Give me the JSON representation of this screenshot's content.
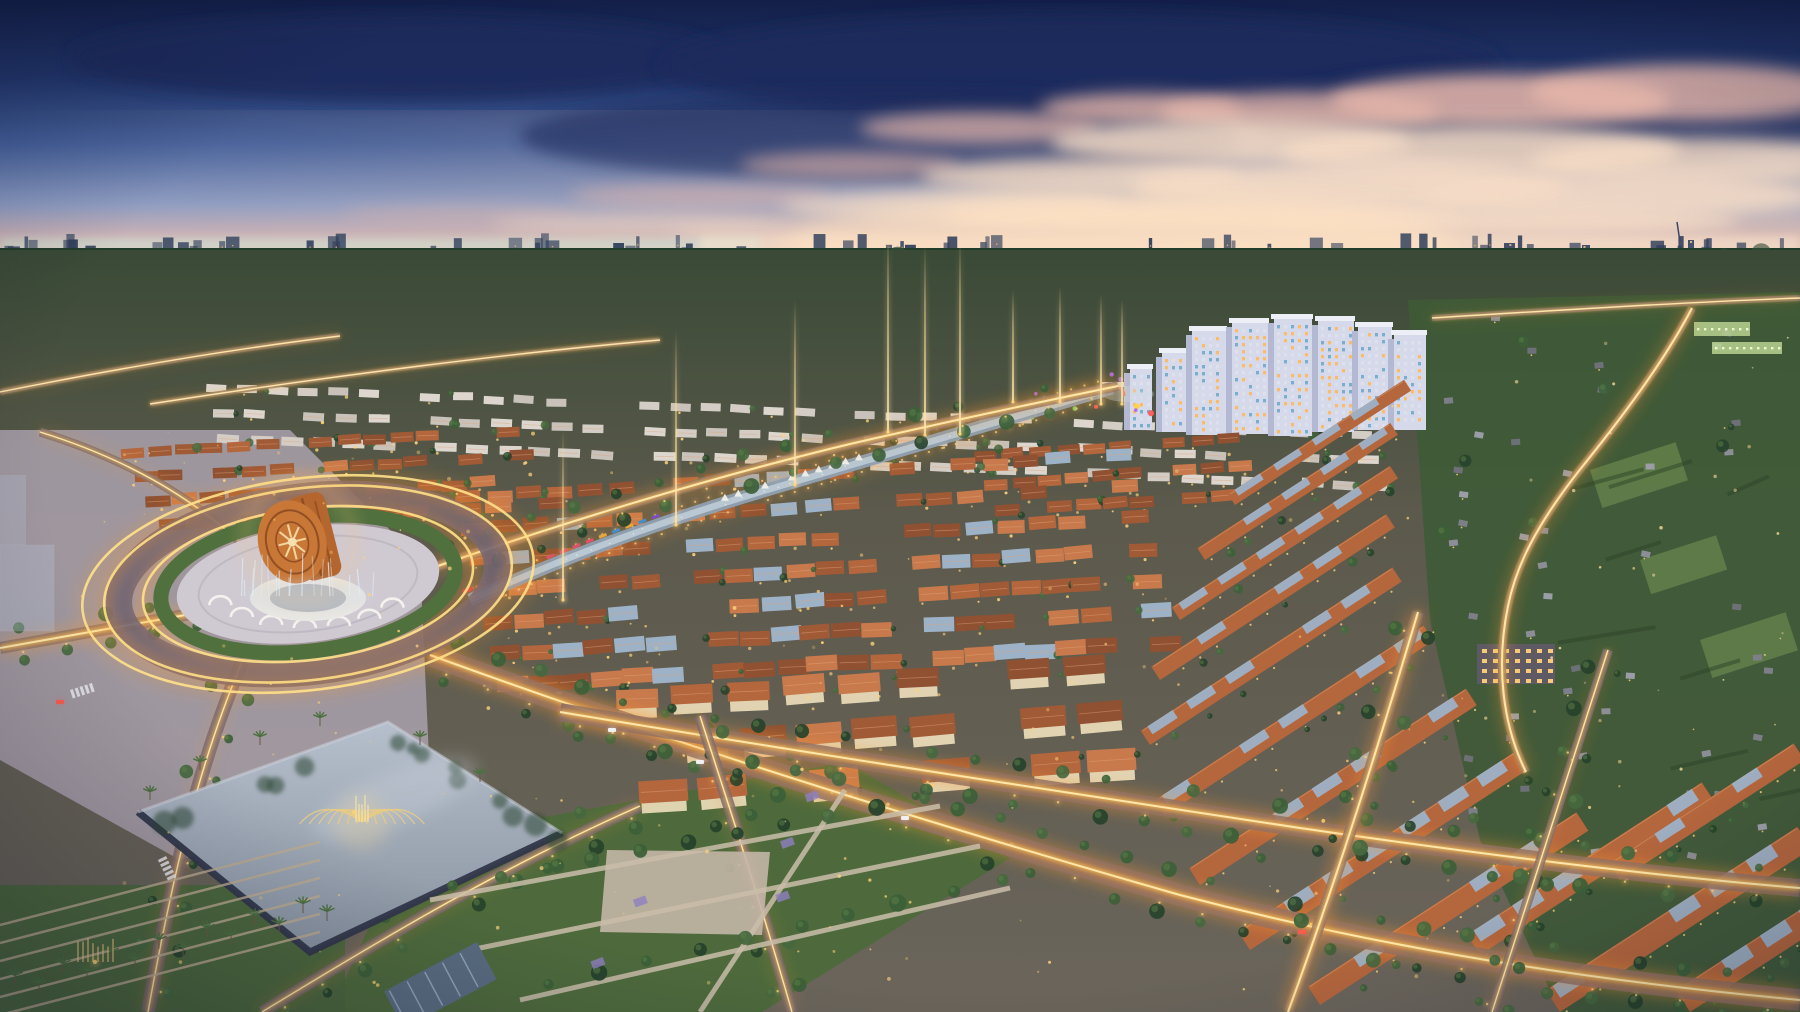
{
  "image": {
    "title": "Aerial dusk rendering of a master-planned township",
    "type": "architectural-render-photo",
    "time_of_day": "dusk",
    "width": 1800,
    "height": 1012,
    "landmarks": [
      {
        "name": "bronze-drum-monument-roundabout"
      },
      {
        "name": "musical-fountain-lake"
      },
      {
        "name": "apartment-tower-cluster"
      },
      {
        "name": "canal-promenade"
      },
      {
        "name": "villa-grid"
      },
      {
        "name": "townhouse-rows"
      },
      {
        "name": "lit-boulevards"
      },
      {
        "name": "distant-city-skyline"
      }
    ]
  },
  "palette": {
    "sky_top": "#131f48",
    "sky_mid": "#2c4378",
    "sky_low": "#8194be",
    "sky_pink": "#dcb3ab",
    "sky_peach": "#f5d9c2",
    "horizon_teal": "#c6e6da",
    "cloud_dark": "#1c2c5c",
    "cloud_pink": "#e7b7aa",
    "cloud_cream": "#f6dcc6",
    "skyline": "#31405c",
    "forest_dark": "#20382a",
    "forest_mid": "#33503a",
    "ground": "#6b6254",
    "lawn": "#5c7a40",
    "park_green": "#4e6a3c",
    "village_green": "#3f5a37",
    "tree_dark": "#26422b",
    "tree_mid": "#3c6038",
    "palm": "#4d7040",
    "road": "#6e6474",
    "plaza": "#aaa1ad",
    "path": "#cabda9",
    "trail_glow": "#ff9a2e",
    "trail_gold": "#ffc24f",
    "trail_core": "#ffeab0",
    "roof_terracotta": "#b4663d",
    "roof_terracotta_dark": "#8f5132",
    "roof_terracotta_light": "#c97a4c",
    "roof_white": "#dcd6cf",
    "roof_panel": "#9db2c7",
    "wall_lit": "#f0e0bd",
    "window_gold": "#ffd27a",
    "window_warm": "#ffb85c",
    "apt_face": "#d6d9e9",
    "apt_side": "#b3b9d3",
    "apt_top": "#edeff6",
    "canal_water": "#8fa0b2",
    "canal_light": "#c3d2dc",
    "drum_copper": "#b5662e",
    "drum_dark": "#84451e",
    "drum_face": "#c87737",
    "pavilion": "#e9e7e3",
    "fountain": "#e9cb82",
    "beam": "#ffd98c",
    "lake_top": "#b6bfcc",
    "lake_bottom": "#87929f",
    "lake_wall": "#31374a",
    "ghost": "#b9c6da",
    "car_white": "#f2f4f8",
    "car_red": "#ff5a4a"
  },
  "sky": {
    "clouds": [
      [
        400,
        58,
        330,
        42,
        "cloud_dark",
        0.9
      ],
      [
        1080,
        66,
        420,
        52,
        "cloud_dark",
        0.9
      ],
      [
        1560,
        116,
        320,
        48,
        "cloud_dark",
        0.75
      ],
      [
        880,
        136,
        360,
        44,
        "cloud_dark",
        0.6
      ],
      [
        1140,
        108,
        100,
        15,
        "cloud_pink",
        0.8
      ],
      [
        1300,
        112,
        140,
        20,
        "cloud_pink",
        0.8
      ],
      [
        1500,
        100,
        170,
        26,
        "cloud_pink",
        0.85
      ],
      [
        1690,
        92,
        160,
        28,
        "cloud_pink",
        0.8
      ],
      [
        980,
        128,
        120,
        16,
        "cloud_pink",
        0.7
      ],
      [
        1230,
        142,
        180,
        22,
        "cloud_cream",
        0.85
      ],
      [
        1480,
        152,
        200,
        26,
        "cloud_cream",
        0.85
      ],
      [
        1700,
        162,
        170,
        24,
        "cloud_cream",
        0.8
      ],
      [
        850,
        165,
        110,
        13,
        "cloud_pink",
        0.6
      ],
      [
        1080,
        176,
        160,
        18,
        "cloud_cream",
        0.8
      ],
      [
        1350,
        186,
        220,
        24,
        "cloud_cream",
        0.9
      ],
      [
        1620,
        196,
        200,
        22,
        "cloud_cream",
        0.85
      ],
      [
        700,
        196,
        130,
        12,
        "cloud_pink",
        0.5
      ],
      [
        950,
        206,
        170,
        15,
        "cloud_cream",
        0.7
      ],
      [
        1200,
        216,
        260,
        17,
        "cloud_cream",
        0.9
      ],
      [
        1500,
        221,
        240,
        15,
        "cloud_cream",
        0.85
      ],
      [
        460,
        214,
        120,
        9,
        "sky_pink",
        0.4
      ],
      [
        640,
        224,
        150,
        9,
        "cloud_cream",
        0.5
      ],
      [
        760,
        232,
        90,
        7,
        "cloud_cream",
        0.55
      ]
    ]
  },
  "horizon": {
    "glow_center": [
      1120,
      250
    ],
    "features": [
      [
        12,
        252,
        18,
        46
      ],
      [
        76,
        266,
        10,
        32
      ],
      [
        168,
        271,
        76,
        17
      ],
      [
        1258,
        258,
        15,
        36
      ],
      [
        1504,
        243,
        11,
        18
      ],
      [
        1582,
        245,
        8,
        14
      ],
      [
        1688,
        240,
        6,
        15
      ],
      [
        410,
        262,
        12,
        30
      ]
    ]
  },
  "bright_corridor": {
    "d": "M372,276 C700,290 1080,318 1462,352"
  },
  "canal": {
    "d": "M470,600 C560,560 640,528 760,492 C880,456 1000,420 1112,388"
  },
  "roundabout": {
    "cx": 308,
    "cy": 584
  },
  "lake": {
    "points": "388,722 562,833 310,952 138,812",
    "fountain": [
      362,
      822
    ]
  },
  "beams": [
    [
      563,
      430,
      170
    ],
    [
      676,
      330,
      195
    ],
    [
      795,
      300,
      185
    ],
    [
      888,
      232,
      200
    ],
    [
      925,
      245,
      190
    ],
    [
      960,
      238,
      196
    ],
    [
      1013,
      290,
      112
    ],
    [
      1060,
      286,
      116
    ],
    [
      1101,
      294,
      110
    ],
    [
      1122,
      300,
      104
    ]
  ],
  "apartments": [
    [
      1130,
      368,
      22,
      62
    ],
    [
      1162,
      352,
      26,
      80
    ],
    [
      1192,
      330,
      34,
      105
    ],
    [
      1232,
      322,
      36,
      112
    ],
    [
      1274,
      318,
      38,
      118
    ],
    [
      1318,
      320,
      36,
      112
    ],
    [
      1358,
      326,
      34,
      104
    ],
    [
      1394,
      334,
      32,
      96
    ]
  ],
  "villa_groups": [
    {
      "x": 205,
      "y": 383,
      "cols": 38,
      "rows": 3,
      "dxc": 31,
      "dyc": 1.3,
      "dxr": 7,
      "dyr": 25,
      "w": 20,
      "h": 8,
      "roof": "white",
      "grow": 0.15
    },
    {
      "x": 975,
      "y": 452,
      "cols": 10,
      "rows": 3,
      "dxc": 27,
      "dyc": -2,
      "dxr": 9,
      "dyr": 27,
      "w": 22,
      "h": 10,
      "roof": "terracotta",
      "grow": 0.2
    },
    {
      "x": 455,
      "y": 492,
      "cols": 22,
      "rows": 7,
      "dxc": 31,
      "dyc": -2,
      "dxr": 7,
      "dyr": 31,
      "w": 25,
      "h": 12,
      "roof": "mixed",
      "grow": 0.3
    },
    {
      "x": 120,
      "y": 448,
      "cols": 15,
      "rows": 4,
      "dxc": 27,
      "dyc": -1.5,
      "dxr": 13,
      "dyr": 24,
      "w": 23,
      "h": 10,
      "roof": "terracotta",
      "grow": 0.2
    },
    {
      "x": 615,
      "y": 690,
      "cols": 9,
      "rows": 3,
      "dxc": 56,
      "dyc": -4,
      "dxr": 12,
      "dyr": 46,
      "w": 42,
      "h": 19,
      "roof": "terracotta",
      "grow": 0.25,
      "big": 1
    }
  ],
  "townhouse_slabs": [
    [
      1235,
      505,
      210,
      13
    ],
    [
      1205,
      560,
      230,
      14
    ],
    [
      1180,
      620,
      260,
      15
    ],
    [
      1160,
      680,
      280,
      16
    ],
    [
      1150,
      745,
      300,
      17
    ],
    [
      1165,
      815,
      320,
      18
    ],
    [
      1200,
      885,
      330,
      20
    ],
    [
      1250,
      950,
      330,
      22
    ],
    [
      1320,
      1005,
      320,
      22
    ],
    [
      1480,
      955,
      280,
      24
    ],
    [
      1560,
      1012,
      300,
      26
    ],
    [
      1690,
      1012,
      240,
      26
    ],
    [
      1620,
      880,
      220,
      20
    ]
  ],
  "roads": [
    {
      "d": "M430,655 C650,735 900,815 1180,895 C1420,958 1640,985 1800,1000",
      "w": 22,
      "t": 2
    },
    {
      "d": "M560,712 C800,752 1050,790 1300,828 C1520,860 1680,878 1800,888",
      "w": 18,
      "t": 2
    },
    {
      "d": "M1418,612 C1380,740 1340,870 1288,1012",
      "w": 12,
      "t": 2
    },
    {
      "d": "M1608,650 C1570,770 1530,890 1492,1012",
      "w": 10,
      "t": 1
    },
    {
      "d": "M700,716 C730,810 760,900 792,1012",
      "w": 12,
      "t": 1
    },
    {
      "d": "M262,1012 C380,940 500,868 640,806",
      "w": 12,
      "t": 1
    },
    {
      "d": "M0,648 C110,628 210,610 292,596",
      "w": 12,
      "t": 2
    },
    {
      "d": "M148,1012 C170,890 196,770 242,662",
      "w": 14,
      "t": 1
    },
    {
      "d": "M238,540 C190,498 130,460 40,432",
      "w": 9,
      "t": 1
    },
    {
      "d": "M432,568 C560,524 700,480 850,444 C950,421 1040,402 1118,386",
      "w": 10,
      "t": 2
    },
    {
      "d": "M1692,308 C1664,362 1620,420 1578,472 C1536,526 1516,566 1508,606 C1496,664 1502,724 1526,772",
      "w": 8,
      "t": 2
    },
    {
      "d": "M1432,318 C1560,310 1690,302 1800,298",
      "w": 6,
      "t": 1
    },
    {
      "d": "M0,392 C120,368 240,348 340,336",
      "w": 6,
      "t": 1
    },
    {
      "d": "M150,404 C330,376 520,352 660,340",
      "w": 5,
      "t": 1
    }
  ],
  "cars": [
    [
      700,
      762,
      "car_white"
    ],
    [
      905,
      818,
      "car_white"
    ],
    [
      1302,
      932,
      "car_red"
    ],
    [
      612,
      730,
      "car_white"
    ],
    [
      60,
      702,
      "car_red"
    ]
  ],
  "village": {
    "school": [
      1477,
      644,
      78,
      40
    ],
    "green_buildings": [
      [
        1694,
        322,
        56,
        14
      ],
      [
        1712,
        342,
        70,
        12
      ]
    ],
    "fields": [
      [
        1590,
        470,
        90,
        40
      ],
      [
        1640,
        560,
        80,
        36
      ],
      [
        1700,
        640,
        90,
        40
      ]
    ]
  }
}
